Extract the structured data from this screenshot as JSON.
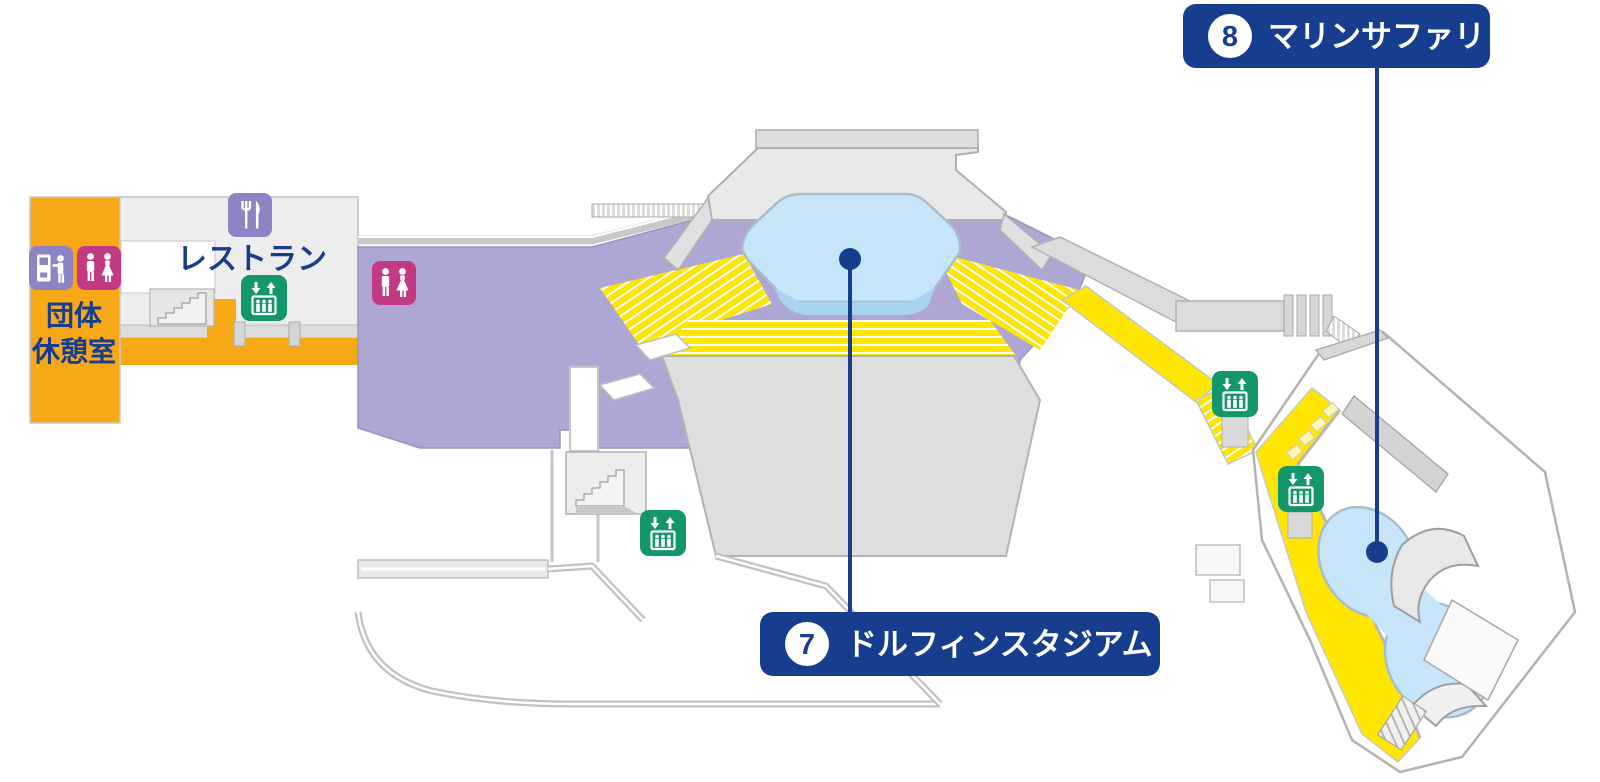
{
  "areas": {
    "group_rest_room": {
      "name": "団体休憩室",
      "line1": "団体",
      "line2": "休憩室"
    },
    "restaurant": {
      "name": "レストラン"
    }
  },
  "callouts": {
    "dolphin_stadium": {
      "number": "7",
      "label": "ドルフィンスタジアム"
    },
    "marine_safari": {
      "number": "8",
      "label": "マリンサファリ"
    }
  },
  "icons": {
    "restaurant": "fork-and-knife",
    "restroom": "men-women-figures",
    "elevator": "up-down-arrows-with-people-in-lift",
    "locker": "coin-locker-with-person"
  },
  "colors": {
    "navy": "#173E8E",
    "yellow": "#FFE600",
    "purple": "#AEA7D3",
    "orange": "#F7A817",
    "pool": "#C6E5F8",
    "green": "#13966B",
    "magenta": "#C23A84",
    "icon_purple": "#8D84C5",
    "grey_line": "#B3B3B3"
  }
}
